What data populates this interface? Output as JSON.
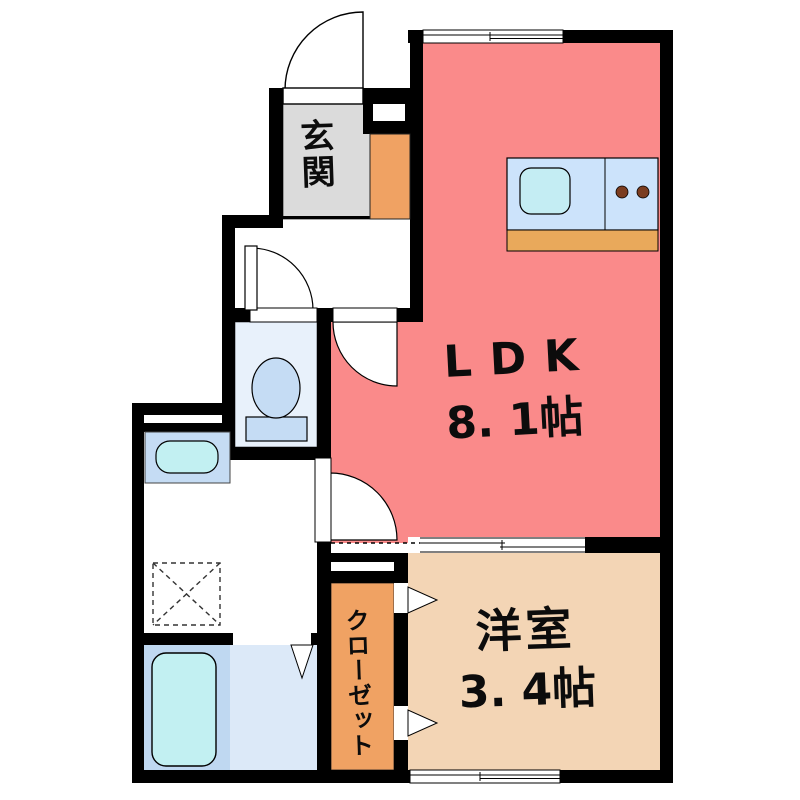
{
  "floorplan": {
    "type": "japanese-apartment-floor-plan",
    "rooms": {
      "ldk": {
        "label": "LDK",
        "size": "8. 1帖"
      },
      "bedroom": {
        "label": "洋室",
        "size": "3. 4帖"
      },
      "entrance": {
        "label": "玄関"
      },
      "closet": {
        "label": "クローゼット"
      }
    },
    "fixtures": [
      "kitchen-counter",
      "kitchen-sink",
      "gas-burners",
      "toilet",
      "washbasin",
      "washing-machine-space",
      "bathtub",
      "shoe-cabinet",
      "entry-door",
      "toilet-door",
      "ldk-door",
      "washroom-door",
      "bathroom-folding-door",
      "closet-folding-doors",
      "sliding-partition",
      "window-top",
      "window-bottom"
    ],
    "colors": {
      "wall": "#000000",
      "ldk_floor": "#FA8A8A",
      "bedroom_floor": "#F3D5B5",
      "closet_floor": "#F0A263",
      "shoe_cabinet": "#F0A263",
      "entrance_floor": "#DBDBDB",
      "kitchen_counter": "#CCE3FB",
      "kitchen_base": "#E9A95B",
      "sink": "#C4EDF3",
      "burner": "#7B3D20",
      "toilet_room": "#E8F1FB",
      "fixture_blue": "#C5DCF4",
      "bath_left": "#BFD8F1",
      "bath_right": "#DCE9F8",
      "bathtub": "#C2F0F2"
    }
  }
}
